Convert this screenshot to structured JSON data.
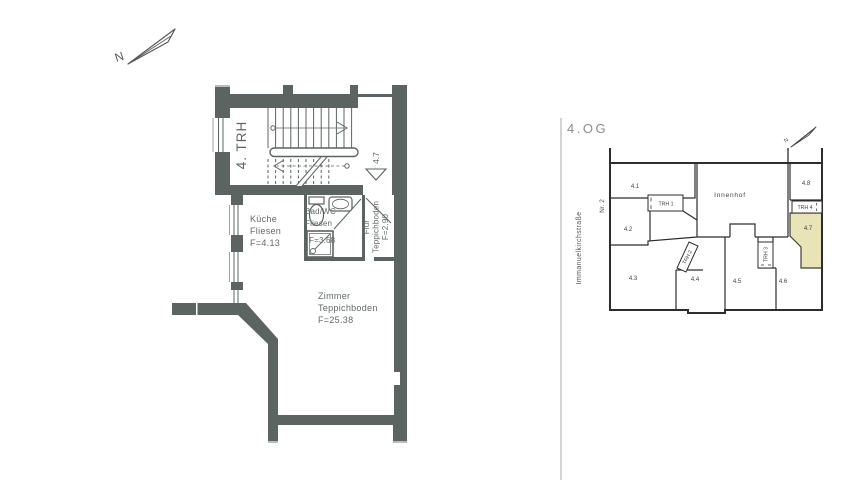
{
  "main_plan": {
    "north_label": "N",
    "stairwell_label": "4. TRH",
    "entrance_unit_label": "4.7",
    "wall_color": "#5c6462",
    "rooms": {
      "kueche": {
        "name": "Küche",
        "floor": "Fliesen",
        "area": "F=4.13"
      },
      "bad": {
        "name": "Bad/WC",
        "floor": "Fliesen",
        "area": "F=3.68"
      },
      "flur": {
        "name": "Flur",
        "floor": "Teppichboden",
        "area": "F=2.90"
      },
      "zimmer": {
        "name": "Zimmer",
        "floor": "Teppichboden",
        "area": "F=25.38"
      }
    }
  },
  "overview": {
    "title": "4.OG",
    "street_label": "Immanuelkirchstraße",
    "number_label": "Nr. 2",
    "north_label": "N",
    "courtyard_label": "Innenhof",
    "units": [
      "4.1",
      "4.2",
      "4.3",
      "4.4",
      "4.5",
      "4.6",
      "4.7",
      "4.8"
    ],
    "stairwells": [
      "TRH 1",
      "TRH 2",
      "TRH 3",
      "TRH 4"
    ],
    "highlighted_unit": "4.7",
    "highlight_color": "#e9e4b8"
  }
}
